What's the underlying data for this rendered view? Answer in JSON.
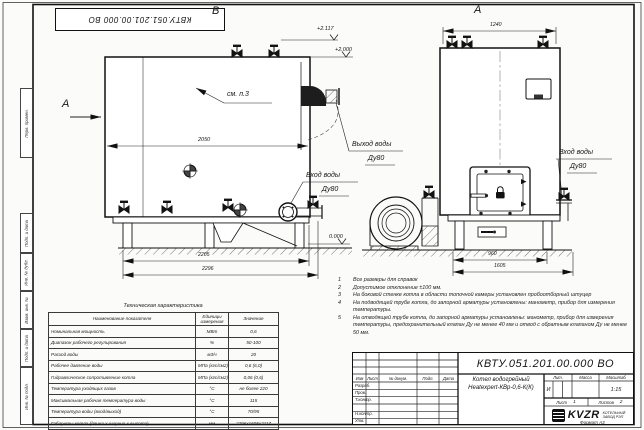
{
  "sheet": {
    "stamp_top": "КВТУ.051.201.00.000 ВО",
    "format_label": "Формат А3",
    "margin_labels": [
      "Перв. примен.",
      "Подп. и дата",
      "Инв. № дубл.",
      "Взам. инв. №",
      "Подп. и дата",
      "Инв. № подл."
    ]
  },
  "views": {
    "top_view_label": "В",
    "front_view_label": "А",
    "section_arrow_label": "А",
    "callout_see_note": "см. п.3",
    "elevations": {
      "valve_top": "+2.117",
      "boiler_top": "+2.000",
      "ground": "0.000"
    },
    "left_dims": {
      "body_length": "2050",
      "frame_length": "2205",
      "total_length": "2296"
    },
    "right_dims": {
      "top_width": "1240",
      "frame_width": "960",
      "total_width": "1605"
    },
    "labels": {
      "outlet_line1": "Выход воды",
      "outlet_line2": "Ду80",
      "inlet_left_line1": "Вход воды",
      "inlet_left_line2": "Ду80",
      "inlet_right_line1": "Вход воды",
      "inlet_right_line2": "Ду80"
    }
  },
  "notes": {
    "items": [
      {
        "n": "1",
        "text": "Все размеры для справок"
      },
      {
        "n": "2",
        "text": "Допустимое отклонение ±100 мм."
      },
      {
        "n": "3",
        "text": "На боковой стенке котла в области топочной камеры установлен пробоотборный штуцер"
      },
      {
        "n": "4",
        "text": "На подводящей трубе котла, до запорной арматуры установлены: манометр, прибор для измерения температуры."
      },
      {
        "n": "5",
        "text": "На отводящей трубе котла, до запорной арматуры установлены: манометр, прибор для измерения температуры, предохранительный клапан Ду не менее 40 мм и отвод с обратным клапаном Ду не менее 50 мм."
      }
    ]
  },
  "tech_table": {
    "title": "Техническая характеристика",
    "headers": [
      "Наименование показателя",
      "Единицы измерения",
      "Значение"
    ],
    "rows": [
      [
        "Номинальная мощность",
        "МВт",
        "0,6"
      ],
      [
        "Диапазон рабочего регулирования",
        "%",
        "50-100"
      ],
      [
        "Расход воды",
        "м3/ч",
        "20"
      ],
      [
        "Рабочее давление воды",
        "МПа (кгс/см2)",
        "0,6 (6,0)"
      ],
      [
        "Гидравлическое сопротивление котла",
        "МПа (кгс/см2)",
        "0,06 (0,6)"
      ],
      [
        "Температура уходящих газов",
        "°С",
        "не более 220"
      ],
      [
        "Максимальная рабочая температура воды",
        "°С",
        "115"
      ],
      [
        "Температура воды (вход/выход)",
        "°С",
        "70/95"
      ],
      [
        "Габариты котла (длина х ширина х высота)",
        "мм",
        "2296х1605х2117"
      ]
    ]
  },
  "title_block": {
    "doc_number": "КВТУ.051.201.00.000  ВО",
    "product_line1": "Котел водогрейный",
    "product_line2": "Heatexpert-КВр-0,6-К(К)",
    "col_headers": {
      "izm": "Изм",
      "list": "Лист",
      "doc": "№ докум.",
      "podp": "Подп.",
      "data": "Дата"
    },
    "row_labels": {
      "razrab": "Разраб.",
      "prov": "Пров.",
      "tkontr": "Т.контр.",
      "nkontr": "Н.контр.",
      "utv": "Утв."
    },
    "lit": {
      "header": "Лит.",
      "value": "И"
    },
    "mass": {
      "header": "Масса"
    },
    "scale": {
      "header": "Масштаб",
      "value": "1:15"
    },
    "sheet": {
      "label": "Лист",
      "value": "1"
    },
    "sheets": {
      "label": "Листов",
      "value": "2"
    },
    "logo": {
      "text": "KVZR",
      "company_line1": "КОТЕЛЬНЫЙ",
      "company_line2": "ЗАВОД РЭП"
    }
  }
}
